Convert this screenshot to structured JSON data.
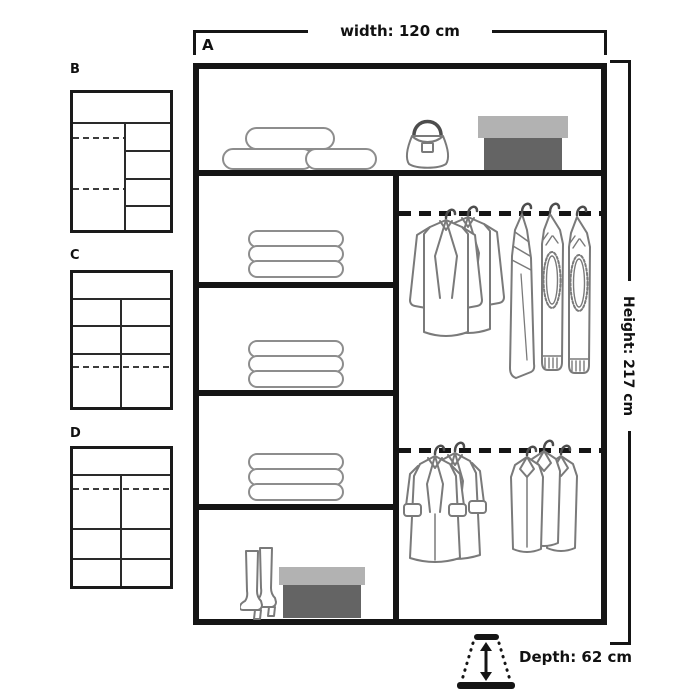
{
  "main_unit": {
    "label": "A",
    "contents": {
      "top_shelf_icons": [
        "rolled-linens-icon",
        "handbag-icon",
        "storage-box-icon"
      ],
      "left_column_icons": [
        "folded-clothes-icon",
        "folded-clothes-icon",
        "folded-clothes-icon",
        "boots-icon",
        "shoe-box-icon"
      ],
      "right_column_icons": [
        "clothes-rail-icon",
        "hanging-jackets-icon",
        "hanging-sweaters-icon",
        "clothes-rail-icon",
        "hanging-coats-icon",
        "hanging-shirts-icon"
      ]
    }
  },
  "variants": [
    {
      "label": "B"
    },
    {
      "label": "C"
    },
    {
      "label": "D"
    }
  ],
  "dimensions": {
    "width": {
      "label": "width: 120 cm"
    },
    "height": {
      "label": "Height: 217 cm"
    },
    "depth": {
      "label": "Depth: 62 cm",
      "icon": "depth-perspective-arrow-icon"
    }
  },
  "colors": {
    "line": "#151515",
    "garment_outline": "#7a7a7a",
    "box_lid": "#b2b2b2",
    "box_body": "#646464"
  }
}
